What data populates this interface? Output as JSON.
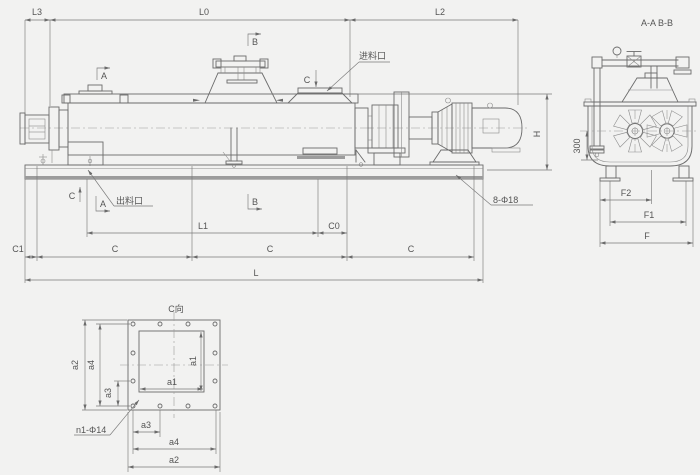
{
  "colors": {
    "background": "#f2f2f1",
    "line": "#6b6b6b",
    "dim_line": "#7a7a7a",
    "text": "#555555"
  },
  "front_view": {
    "dims": {
      "l3": "L3",
      "l0": "L0",
      "l2": "L2",
      "l1": "L1",
      "l_total": "L",
      "c0": "C0",
      "c1": "C1",
      "c": "C",
      "h": "H"
    },
    "labels": {
      "inlet": "进料口",
      "outlet": "出料口",
      "base_holes": "8-Φ18"
    },
    "section_markers": {
      "a": "A",
      "b": "B",
      "c": "C"
    }
  },
  "section_view": {
    "title": "A-A B-B",
    "dims": {
      "f": "F",
      "f1": "F1",
      "f2": "F2",
      "drain_height": "300"
    }
  },
  "flange_view": {
    "title": "C向",
    "dims": {
      "a1": "a1",
      "a2": "a2",
      "a3": "a3",
      "a4": "a4"
    },
    "hole_label": "n1-Φ14"
  }
}
